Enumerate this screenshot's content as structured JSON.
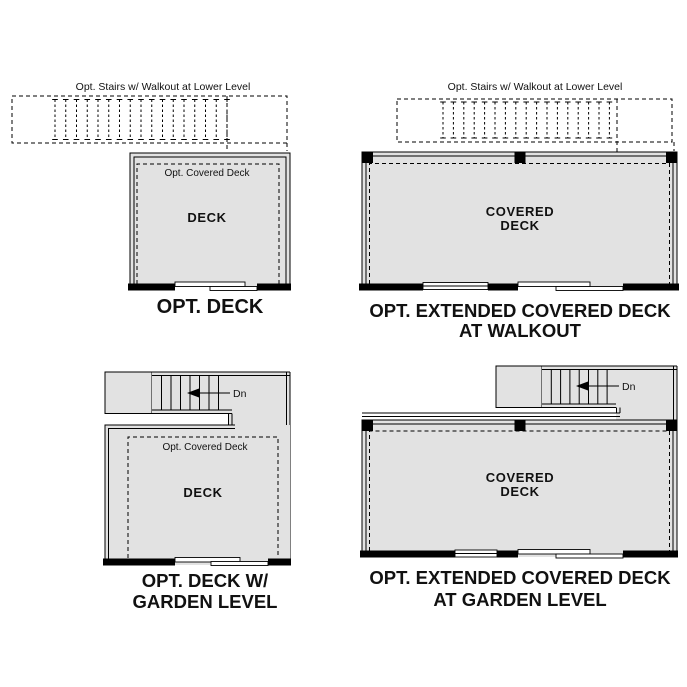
{
  "page": {
    "background": "#ffffff"
  },
  "colors": {
    "deck_fill": "#e2e2e2",
    "line": "#000000",
    "wall": "#000000",
    "opening": "#ffffff"
  },
  "diagrams": {
    "opt_deck": {
      "stairs_note": "Opt. Stairs w/ Walkout at Lower Level",
      "covered_label": "Opt. Covered Deck",
      "room_label": "DECK",
      "caption": "OPT. DECK"
    },
    "extended_walkout": {
      "stairs_note": "Opt. Stairs w/ Walkout at Lower Level",
      "room_label_line1": "COVERED",
      "room_label_line2": "DECK",
      "caption_line1": "OPT. EXTENDED COVERED DECK",
      "caption_line2": "AT WALKOUT"
    },
    "deck_garden": {
      "down_label": "Dn",
      "covered_label": "Opt. Covered Deck",
      "room_label": "DECK",
      "caption_line1": "OPT. DECK W/",
      "caption_line2": "GARDEN LEVEL"
    },
    "extended_garden": {
      "down_label": "Dn",
      "room_label_line1": "COVERED",
      "room_label_line2": "DECK",
      "caption_line1": "OPT. EXTENDED COVERED DECK",
      "caption_line2": "AT GARDEN LEVEL"
    }
  }
}
